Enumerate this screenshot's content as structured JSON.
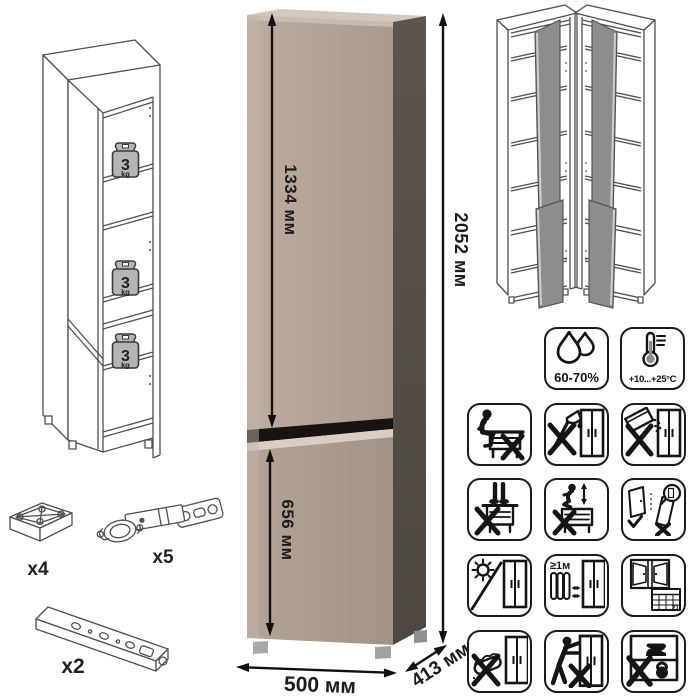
{
  "dimensions": {
    "upper_door": "1334 мм",
    "lower_door": "656 мм",
    "height": "2052 мм",
    "width": "500 мм",
    "depth": "413 мм"
  },
  "shelf_load": {
    "value": "3",
    "unit": "kg"
  },
  "hardware": [
    {
      "icon": "foot-glide-icon",
      "count": "x4"
    },
    {
      "icon": "hinge-icon",
      "count": "x5"
    },
    {
      "icon": "mounting-rail-icon",
      "count": "x2"
    }
  ],
  "climate": {
    "humidity": "60-70%",
    "temperature": "+10...+25°C"
  },
  "placement": {
    "radiator_distance": "≥1м",
    "calendar_day": "21"
  },
  "colors": {
    "front_panel": "#b1a295",
    "side_panel": "#56504a",
    "groove": "#171310",
    "open_door_gray": "#8d8d8d"
  },
  "icons": [
    "humidity-drops-icon",
    "thermometer-icon",
    "no-sitting-icon",
    "no-sharp-tools-icon",
    "no-spilling-icon",
    "no-standing-icon",
    "no-jumping-icon",
    "door-adjustment-icon",
    "no-direct-sunlight-icon",
    "heater-distance-icon",
    "ventilation-schedule-icon",
    "no-wet-cleaning-icon",
    "no-pushing-icon",
    "no-heavy-load-icon"
  ]
}
